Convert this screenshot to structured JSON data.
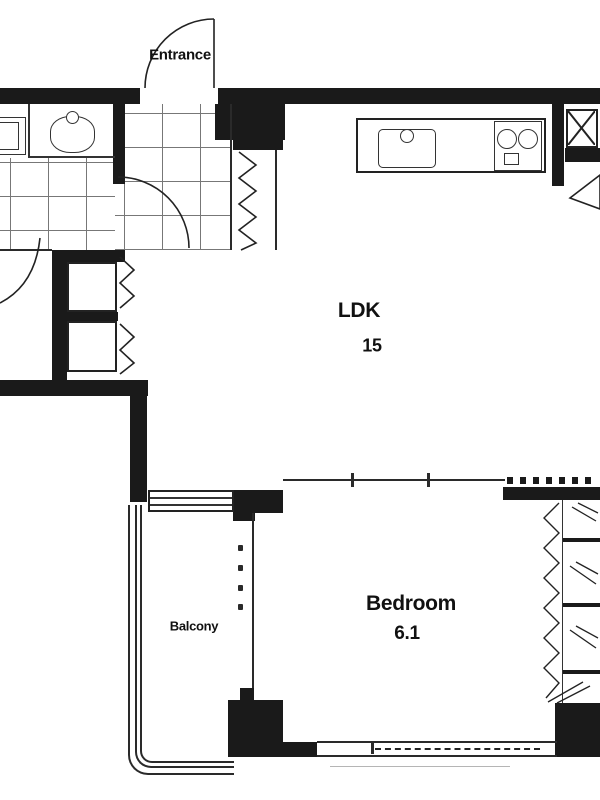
{
  "plan": {
    "labels": {
      "entrance": "Entrance",
      "ldk": "LDK",
      "ldk_area": "15",
      "bedroom": "Bedroom",
      "bedroom_area": "6.1",
      "balcony": "Balcony"
    },
    "colors": {
      "wall": "#1a1a1a",
      "line": "#2a2a2a",
      "grid": "#4a4a4a",
      "background": "#ffffff"
    },
    "fixtures": [
      "toilet",
      "washbasin",
      "kitchen-sink",
      "gas-stove",
      "duct-shaft-x",
      "entry-closet",
      "hall-closet",
      "bedroom-closet",
      "folding-doors",
      "door-swings",
      "balcony-railing",
      "sliding-windows"
    ]
  }
}
